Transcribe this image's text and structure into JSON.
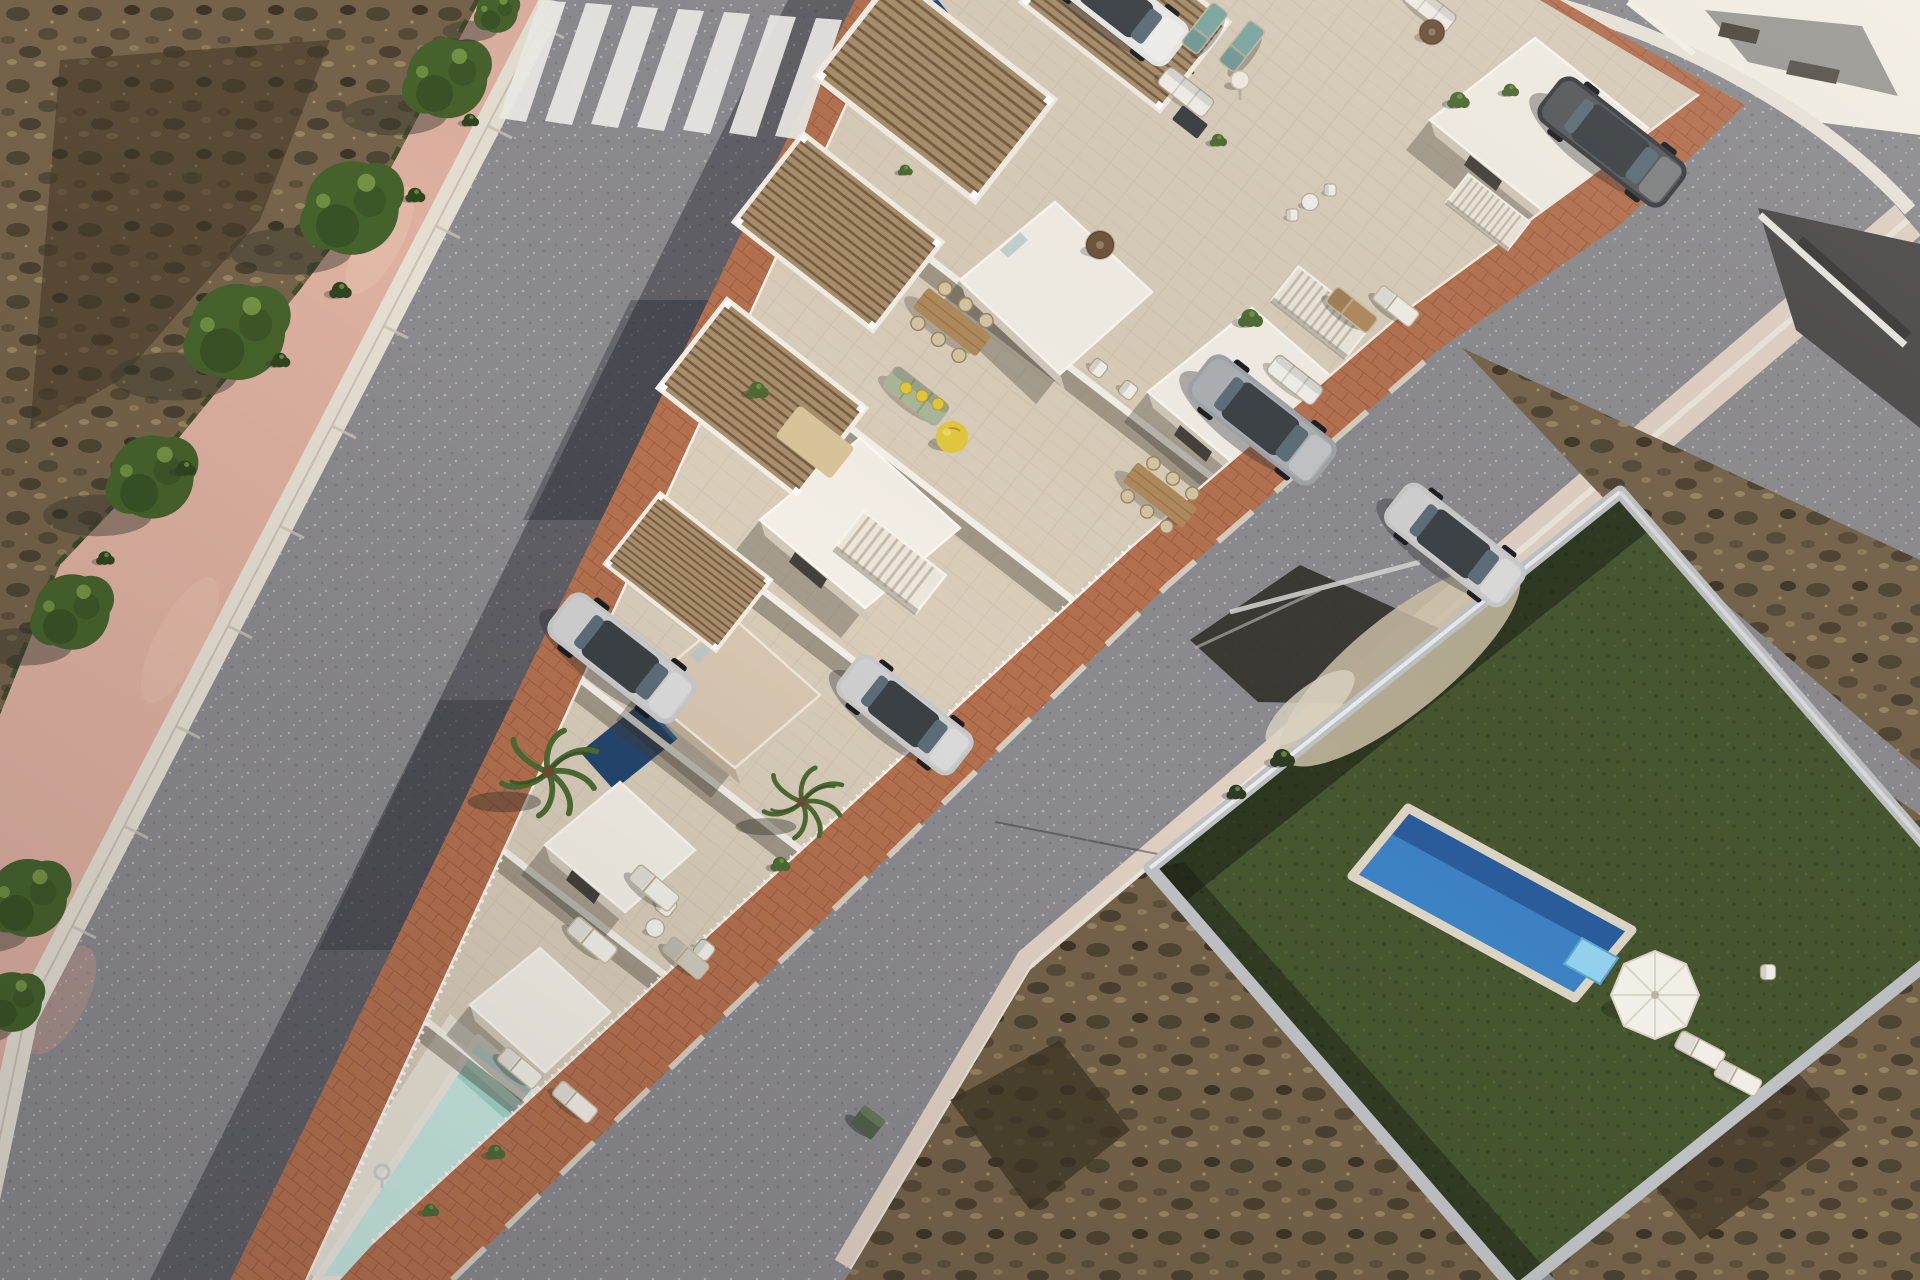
{
  "palette": {
    "road": "#8b8a8e",
    "pink-walk": "#ddb0a0",
    "curb": "#e5dfd2",
    "brick": "#b4714f",
    "brick-line": "#92543a",
    "tile": "#d9cdba",
    "tile-light": "#e3d9c6",
    "pave-light": "#eae4d6",
    "wall-lit": "#f3eee5",
    "wall-shade": "#d2c8ba",
    "wall-greige": "#d9c8b2",
    "opening": "#46403a",
    "wood": "#a88e6c",
    "wood-deck": "#b08a5c",
    "wood-dark": "#6f533a",
    "pool-light": "#c8eae1",
    "pool-light-shade": "#a4d6c9",
    "pool-blue": "#3d82c4",
    "pool-blue-dark": "#2a5d9d",
    "float": "#93d2ee",
    "turf": "#46562f",
    "turf-dark": "#2e3c22",
    "scrub": "#75634a",
    "scrub-dark": "#4c4130",
    "scrub-light": "#97855f",
    "tree-green": "#46622c",
    "tree-dark": "#2f4520",
    "palm-green": "#4e6b33",
    "car-silver": "#c9c9c9",
    "car-gray": "#9fa4a8",
    "car-dark": "#3b3e41",
    "car-white": "#e9e9e7",
    "bin-green": "#51604a",
    "teal": "#7da9a4",
    "yellow": "#e2c83e",
    "white": "#f2efe8",
    "lounger-gray": "#cfcabf",
    "sage": "#a9b79b",
    "rug": "#d9c49a"
  },
  "scene": {
    "items": [
      {
        "kind": "crosswalk-stripe",
        "x": 540,
        "y": 0,
        "n": "crosswalk-stripe"
      },
      {
        "kind": "crosswalk-stripe",
        "x": 586,
        "y": 3,
        "n": "crosswalk-stripe"
      },
      {
        "kind": "crosswalk-stripe",
        "x": 632,
        "y": 6,
        "n": "crosswalk-stripe"
      },
      {
        "kind": "crosswalk-stripe",
        "x": 678,
        "y": 9,
        "n": "crosswalk-stripe"
      },
      {
        "kind": "crosswalk-stripe",
        "x": 724,
        "y": 12,
        "n": "crosswalk-stripe"
      },
      {
        "kind": "crosswalk-stripe",
        "x": 770,
        "y": 15,
        "n": "crosswalk-stripe"
      },
      {
        "kind": "crosswalk-stripe",
        "x": 816,
        "y": 18,
        "n": "crosswalk-stripe"
      },
      {
        "kind": "tree",
        "x": 447,
        "y": 78,
        "s": 1.55
      },
      {
        "kind": "tree",
        "x": 352,
        "y": 208,
        "s": 1.8
      },
      {
        "kind": "tree",
        "x": 237,
        "y": 332,
        "s": 1.85
      },
      {
        "kind": "tree",
        "x": 152,
        "y": 477,
        "s": 1.6
      },
      {
        "kind": "tree",
        "x": 72,
        "y": 612,
        "s": 1.45
      },
      {
        "kind": "tree",
        "x": 497,
        "y": 12,
        "s": 0.8
      },
      {
        "kind": "tree",
        "x": 28,
        "y": 898,
        "s": 1.5
      },
      {
        "kind": "tree",
        "x": 12,
        "y": 1002,
        "s": 1.15
      },
      {
        "kind": "shrub",
        "x": 470,
        "y": 120,
        "s": 0.7,
        "c": "tree-dark",
        "n": "grass-tuft"
      },
      {
        "kind": "shrub",
        "x": 415,
        "y": 195,
        "s": 0.8,
        "c": "tree-dark",
        "n": "grass-tuft"
      },
      {
        "kind": "shrub",
        "x": 340,
        "y": 290,
        "s": 0.9,
        "c": "tree-dark",
        "n": "grass-tuft"
      },
      {
        "kind": "shrub",
        "x": 280,
        "y": 360,
        "s": 0.8,
        "c": "tree-dark",
        "n": "grass-tuft"
      },
      {
        "kind": "shrub",
        "x": 185,
        "y": 468,
        "s": 0.85,
        "c": "tree-dark",
        "n": "grass-tuft"
      },
      {
        "kind": "shrub",
        "x": 105,
        "y": 558,
        "s": 0.75,
        "c": "tree-dark",
        "n": "grass-tuft"
      },
      {
        "kind": "palm",
        "x": 548,
        "y": 772,
        "s": 1.15
      },
      {
        "kind": "palm",
        "x": 802,
        "y": 802,
        "s": 0.95
      },
      {
        "kind": "palm",
        "x": 1168,
        "y": 64,
        "s": 0.62
      },
      {
        "kind": "pergola",
        "x": 1125,
        "y": 12,
        "r": 38,
        "s": 1
      },
      {
        "kind": "pergola",
        "x": 935,
        "y": 88,
        "r": 38,
        "s": 1.15
      },
      {
        "kind": "pergola",
        "x": 838,
        "y": 232,
        "r": 38,
        "s": 1
      },
      {
        "kind": "pergola",
        "x": 762,
        "y": 398,
        "r": 38,
        "s": 1
      },
      {
        "kind": "pergola",
        "x": 688,
        "y": 572,
        "r": 38,
        "s": 0.8
      },
      {
        "kind": "stairs",
        "x": 890,
        "y": 562,
        "r": 38,
        "s": 1
      },
      {
        "kind": "stairs",
        "x": 1322,
        "y": 312,
        "r": 38,
        "s": 0.9
      },
      {
        "kind": "stairs",
        "x": 1488,
        "y": 212,
        "r": 38,
        "s": 0.75
      },
      {
        "kind": "car",
        "x": 622,
        "y": 658,
        "r": 38,
        "s": 1,
        "c": "car-silver",
        "n": "car-silver-driveway"
      },
      {
        "kind": "car",
        "x": 905,
        "y": 715,
        "r": 38,
        "s": 0.92,
        "c": "car-silver",
        "n": "car-silver-driveway"
      },
      {
        "kind": "car",
        "x": 1262,
        "y": 420,
        "r": 38,
        "s": 1,
        "c": "car-gray",
        "n": "car-suv-courtyard"
      },
      {
        "kind": "car",
        "x": 1455,
        "y": 545,
        "r": 38,
        "s": 0.95,
        "c": "car-silver",
        "n": "car-parked-road"
      },
      {
        "kind": "car",
        "x": 1612,
        "y": 142,
        "r": 38,
        "s": 1,
        "c": "car-dark",
        "n": "car-dark-courtyard"
      },
      {
        "kind": "car",
        "x": 1118,
        "y": 4,
        "r": 38,
        "s": 0.95,
        "c": "car-white",
        "n": "car-white-top"
      },
      {
        "kind": "bin",
        "x": 868,
        "y": 1122,
        "r": 38,
        "s": 0.9,
        "n": "wheelie-bin"
      },
      {
        "kind": "sofa",
        "x": 916,
        "y": 396,
        "r": 38,
        "s": 1,
        "c": "sage",
        "n": "terrace-sofa-green"
      },
      {
        "kind": "sofa",
        "x": 1295,
        "y": 380,
        "r": 38,
        "s": 0.85,
        "c": "white",
        "n": "patio-sofa-white"
      },
      {
        "kind": "sofa",
        "x": 1186,
        "y": 92,
        "r": 38,
        "s": 0.85,
        "c": "white",
        "n": "terrace-sofa-white"
      },
      {
        "kind": "sofa",
        "x": 1430,
        "y": 8,
        "r": 38,
        "s": 0.8,
        "c": "white",
        "n": "terrace-sofa-white"
      },
      {
        "kind": "cushion",
        "x": 906,
        "y": 388
      },
      {
        "kind": "cushion",
        "x": 922,
        "y": 396
      },
      {
        "kind": "cushion",
        "x": 938,
        "y": 404
      },
      {
        "kind": "beanbag",
        "x": 952,
        "y": 437,
        "n": "yellow-beanbag"
      },
      {
        "kind": "chair",
        "x": 666,
        "y": 906,
        "r": 38,
        "s": 0.9,
        "c": "white"
      },
      {
        "kind": "chair",
        "x": 704,
        "y": 950,
        "r": 38,
        "s": 0.9,
        "c": "white"
      },
      {
        "kind": "chair",
        "x": 1098,
        "y": 368,
        "r": 38,
        "s": 0.8,
        "c": "white"
      },
      {
        "kind": "chair",
        "x": 1128,
        "y": 390,
        "r": 38,
        "s": 0.8,
        "c": "white"
      },
      {
        "kind": "chair",
        "x": 1768,
        "y": 972,
        "s": 0.75,
        "c": "white"
      },
      {
        "kind": "chair",
        "x": 1292,
        "y": 215,
        "s": 0.6,
        "c": "white"
      },
      {
        "kind": "chair",
        "x": 1330,
        "y": 190,
        "s": 0.6,
        "c": "white"
      },
      {
        "kind": "table-rect",
        "x": 952,
        "y": 322,
        "r": 38,
        "s": 1,
        "n": "dining-table"
      },
      {
        "kind": "table-rect",
        "x": 1160,
        "y": 495,
        "r": 38,
        "s": 0.95,
        "n": "dining-table"
      },
      {
        "kind": "table-round",
        "x": 1100,
        "y": 245,
        "s": 1,
        "c": "wood-dark"
      },
      {
        "kind": "table-round",
        "x": 1432,
        "y": 32,
        "s": 0.9,
        "c": "wood-dark"
      },
      {
        "kind": "table-round",
        "x": 655,
        "y": 928,
        "s": 0.65,
        "c": "white"
      },
      {
        "kind": "table-round",
        "x": 1310,
        "y": 202,
        "s": 0.6,
        "c": "white"
      },
      {
        "kind": "box",
        "x": 1190,
        "y": 122,
        "r": 38,
        "s": 1,
        "c": "car-dark",
        "n": "coffee-table"
      },
      {
        "kind": "box",
        "x": 815,
        "y": 442,
        "r": 38,
        "s": 2.2,
        "c": "rug",
        "n": "terrace-rug"
      },
      {
        "kind": "lounger",
        "x": 592,
        "y": 940,
        "r": 40,
        "s": 1,
        "c": "white"
      },
      {
        "kind": "lounger",
        "x": 654,
        "y": 888,
        "r": 40,
        "s": 1,
        "c": "white"
      },
      {
        "kind": "lounger",
        "x": 686,
        "y": 958,
        "r": 40,
        "s": 0.92,
        "c": "lounger-gray"
      },
      {
        "kind": "lounger",
        "x": 520,
        "y": 1068,
        "r": 40,
        "s": 0.9,
        "c": "white"
      },
      {
        "kind": "lounger",
        "x": 575,
        "y": 1102,
        "r": 40,
        "s": 0.9,
        "c": "white"
      },
      {
        "kind": "lounger",
        "x": 1205,
        "y": 28,
        "r": -52,
        "s": 1,
        "c": "teal"
      },
      {
        "kind": "lounger",
        "x": 1242,
        "y": 46,
        "r": -52,
        "s": 1,
        "c": "teal"
      },
      {
        "kind": "lounger",
        "x": 1352,
        "y": 310,
        "r": 38,
        "s": 1,
        "c": "wood-deck"
      },
      {
        "kind": "lounger",
        "x": 1396,
        "y": 306,
        "r": 38,
        "s": 0.9,
        "c": "white"
      },
      {
        "kind": "lounger",
        "x": 1700,
        "y": 1050,
        "r": 28,
        "s": 0.95,
        "c": "white"
      },
      {
        "kind": "lounger",
        "x": 1738,
        "y": 1078,
        "r": 28,
        "s": 0.9,
        "c": "white"
      },
      {
        "kind": "umbrella",
        "x": 1655,
        "y": 995,
        "n": "pool-umbrella"
      },
      {
        "kind": "lamp",
        "x": 1240,
        "y": 80,
        "n": "terrace-lamp"
      },
      {
        "kind": "ladder",
        "x": 382,
        "y": 1172,
        "n": "pool-ladder"
      },
      {
        "kind": "shrub",
        "x": 757,
        "y": 390,
        "s": 0.9,
        "c": "palm-green"
      },
      {
        "kind": "shrub",
        "x": 1250,
        "y": 318,
        "s": 1,
        "c": "palm-green"
      },
      {
        "kind": "shrub",
        "x": 1458,
        "y": 100,
        "s": 0.9,
        "c": "palm-green"
      },
      {
        "kind": "shrub",
        "x": 780,
        "y": 864,
        "s": 0.8,
        "c": "palm-green"
      },
      {
        "kind": "shrub",
        "x": 495,
        "y": 1152,
        "s": 0.8,
        "c": "palm-green"
      },
      {
        "kind": "shrub",
        "x": 430,
        "y": 1210,
        "s": 0.7,
        "c": "palm-green"
      },
      {
        "kind": "shrub",
        "x": 1218,
        "y": 140,
        "s": 0.7,
        "c": "palm-green"
      },
      {
        "kind": "shrub",
        "x": 905,
        "y": 170,
        "s": 0.6,
        "c": "palm-green"
      },
      {
        "kind": "shrub",
        "x": 1510,
        "y": 90,
        "s": 0.7,
        "c": "palm-green"
      },
      {
        "kind": "shrub",
        "x": 1282,
        "y": 758,
        "s": 1,
        "c": "turf-dark",
        "n": "villa-hedge"
      },
      {
        "kind": "shrub",
        "x": 1236,
        "y": 792,
        "s": 0.8,
        "c": "turf-dark",
        "n": "villa-hedge"
      }
    ]
  }
}
